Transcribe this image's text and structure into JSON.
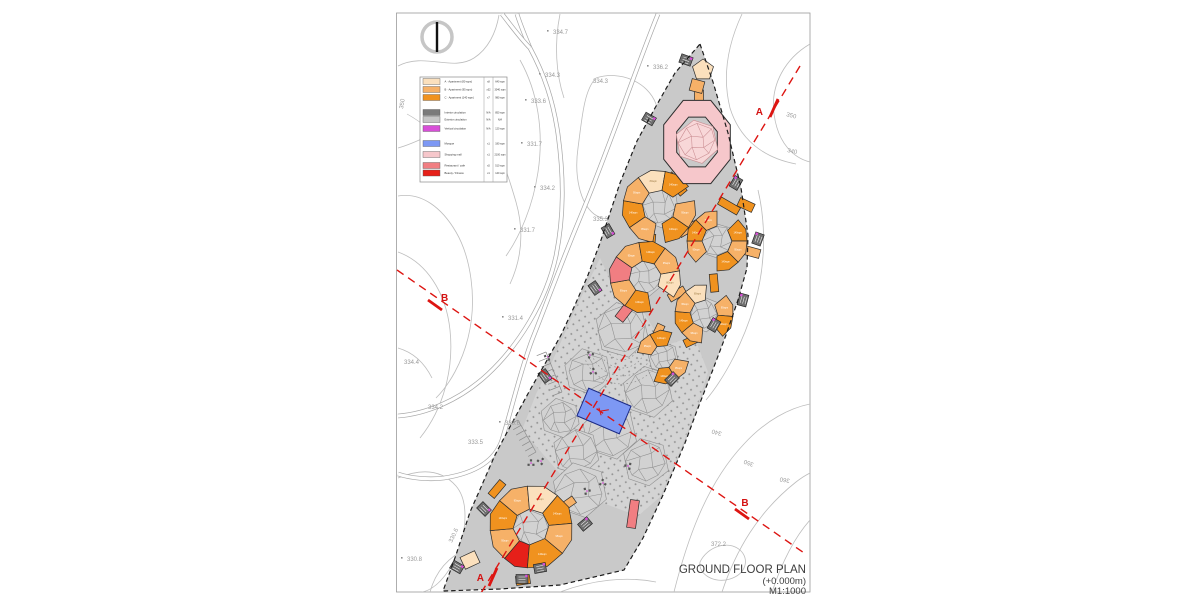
{
  "title": {
    "line1": "GROUND FLOOR PLAN",
    "line2": "(+0.000m)",
    "line3": "M1:1000"
  },
  "colors": {
    "cream": "#fbe0bd",
    "ltorange": "#f6b168",
    "orange": "#f0921f",
    "salmon": "#f17e82",
    "red": "#e62019",
    "pink": "#f6c7cb",
    "pinkLight": "#f8d7d8",
    "pinkLine": "#c98b90",
    "blue": "#7d98f4",
    "blueStroke": "#1b2a86",
    "magenta": "#d84fd8",
    "coreGray": "#6e6e6e",
    "legendGray": "#7a7a7a",
    "legendLtGray": "#c6c6c6",
    "siteGray": "#c9c9c9",
    "plazaGray": "#d4d4d4",
    "dotGray": "#939393",
    "courtGray": "#d2d2d2",
    "courtLine": "#8f8f8f",
    "contour": "#bdbdbd",
    "road": "#a6a6a6",
    "sectionRed": "#dd1512",
    "boundary": "#1c1c1c",
    "label": "#999999",
    "buildingStroke": "#2b2b2b",
    "sheetBorder": "#9a9a9a"
  },
  "legend": {
    "rows": [
      {
        "label": "A · Apartment (80 sqm)",
        "qty": "x8",
        "area": "640 sqm",
        "color": "cream"
      },
      {
        "label": "B · Apartment (95 sqm)",
        "qty": "x32",
        "area": "3040 sqm",
        "color": "ltorange"
      },
      {
        "label": "C · Apartment (140 sqm)",
        "qty": "x7",
        "area": "980 sqm",
        "color": "orange"
      },
      {
        "label": "Interior circulation",
        "qty": "N/A",
        "area": "850 sqm",
        "color": "legendGray"
      },
      {
        "label": "Exterior circulation",
        "qty": "N/A",
        "area": "N/A",
        "color": "legendLtGray"
      },
      {
        "label": "Vertical circulation",
        "qty": "N/A",
        "area": "120 sqm",
        "color": "magenta"
      },
      {
        "label": "Mosque",
        "qty": "x1",
        "area": "180 sqm",
        "color": "blue"
      },
      {
        "label": "Shopping mall",
        "qty": "x1",
        "area": "2100 sqm",
        "color": "pink"
      },
      {
        "label": "Restaurant / cafe",
        "qty": "x5",
        "area": "510 sqm",
        "color": "salmon"
      },
      {
        "label": "Beauty / Fitness",
        "qty": "x1",
        "area": "140 sqm",
        "color": "red"
      }
    ],
    "row_y": [
      81.5,
      89.5,
      97.5,
      112.5,
      119.5,
      128.5,
      143.5,
      154.5,
      165.5,
      173
    ]
  },
  "sections": {
    "a": {
      "label": "A",
      "x1": 800,
      "y1": 66,
      "x2": 478,
      "y2": 598,
      "marks": [
        {
          "lx": 763,
          "ly": 115,
          "anchor": "end",
          "sx1": 770,
          "sy1": 117,
          "sx2": 778,
          "sy2": 99
        },
        {
          "lx": 484,
          "ly": 581,
          "anchor": "end",
          "sx1": 489,
          "sy1": 586,
          "sx2": 497,
          "sy2": 568
        }
      ]
    },
    "b": {
      "label": "B",
      "x1": 397,
      "y1": 270,
      "x2": 807,
      "y2": 555,
      "marks": [
        {
          "lx": 441,
          "ly": 301,
          "anchor": "start",
          "sx1": 428,
          "sy1": 300,
          "sx2": 442,
          "sy2": 310
        },
        {
          "lx": 745,
          "ly": 506,
          "anchor": "middle",
          "sx1": 735,
          "sy1": 509,
          "sx2": 749,
          "sy2": 519
        }
      ]
    }
  },
  "contour_labels": [
    {
      "t": "334.7",
      "x": 553,
      "y": 34,
      "r": 0,
      "d": 1
    },
    {
      "t": "334.3",
      "x": 545,
      "y": 77,
      "r": 0,
      "d": 1
    },
    {
      "t": "334.3",
      "x": 593,
      "y": 83,
      "r": 0,
      "d": 0
    },
    {
      "t": "333.6",
      "x": 531,
      "y": 103,
      "r": 0,
      "d": 1
    },
    {
      "t": "336.2",
      "x": 653,
      "y": 69,
      "r": 0,
      "d": 1
    },
    {
      "t": "331.7",
      "x": 527,
      "y": 146,
      "r": 0,
      "d": 1
    },
    {
      "t": "334.2",
      "x": 540,
      "y": 190,
      "r": 0,
      "d": 1
    },
    {
      "t": "331.7",
      "x": 520,
      "y": 232,
      "r": 0,
      "d": 1
    },
    {
      "t": "335.3",
      "x": 593,
      "y": 221,
      "r": 0,
      "d": 0
    },
    {
      "t": "331.4",
      "x": 508,
      "y": 320,
      "r": 0,
      "d": 1
    },
    {
      "t": "334.4",
      "x": 404,
      "y": 364,
      "r": 0,
      "d": 0
    },
    {
      "t": "334.2",
      "x": 428,
      "y": 409,
      "r": 0,
      "d": 0
    },
    {
      "t": "330.6",
      "x": 505,
      "y": 425,
      "r": 0,
      "d": 1
    },
    {
      "t": "333.5",
      "x": 468,
      "y": 444,
      "r": 0,
      "d": 0
    },
    {
      "t": "330.8",
      "x": 407,
      "y": 561,
      "r": 0,
      "d": 1
    },
    {
      "t": "330.6",
      "x": 452,
      "y": 543,
      "r": -65,
      "d": 0
    },
    {
      "t": "372.2",
      "x": 711,
      "y": 546,
      "r": 0,
      "d": 0
    },
    {
      "t": "350",
      "x": 786,
      "y": 116,
      "r": 15,
      "d": 0
    },
    {
      "t": "340",
      "x": 787,
      "y": 152,
      "r": 12,
      "d": 0
    },
    {
      "t": "340",
      "x": 722,
      "y": 432,
      "r": 195,
      "d": 0
    },
    {
      "t": "350",
      "x": 754,
      "y": 463,
      "r": 200,
      "d": 0
    },
    {
      "t": "360",
      "x": 790,
      "y": 479,
      "r": 190,
      "d": 0
    },
    {
      "t": "350",
      "x": 403,
      "y": 109,
      "r": -80,
      "d": 0
    }
  ],
  "sheet": {
    "x": 396.5,
    "y": 13,
    "w": 413.5,
    "h": 579
  },
  "north": {
    "cx": 437,
    "cy": 37,
    "r": 15
  },
  "contours": [
    "M398,66 C425,52 452,72 474,58 C488,49 496,33 499,15",
    "M398,148 C428,140 452,118 472,126 C496,136 506,168 516,202 C524,230 522,258 510,284",
    "M398,196 C422,192 442,208 456,232 C470,256 478,298 468,338 C462,362 450,384 436,398",
    "M398,252 C426,262 446,292 450,330 C454,368 444,408 420,438",
    "M398,478 C422,468 442,470 456,486 C468,500 468,528 456,556 C448,576 434,590 422,592",
    "M430,592 C436,570 450,556 468,548",
    "M596,78 C620,70 648,82 656,104 C664,128 658,162 644,190 C632,214 610,226 594,214 C580,203 574,176 578,148 C582,118 584,90 596,78",
    "M560,14 C554,44 556,74 564,98",
    "M520,60 C538,92 544,132 538,172 C533,206 520,236 506,256",
    "M742,14 C728,44 722,76 730,108 C740,140 764,158 796,164",
    "M810,44 C786,58 770,84 774,114 C778,144 794,158 810,162",
    "M758,190 C766,224 766,266 754,306 C744,340 726,376 706,400",
    "M672,600 C686,542 706,484 744,444 C766,420 790,408 810,404",
    "M722,592 C736,550 758,512 796,482 C801,478 806,475 810,473",
    "M772,592 C782,562 794,538 810,520",
    "M700,562 C708,546 728,540 740,550 C750,559 746,574 730,579 C714,584 698,574 700,562",
    "M560,592 C592,580 626,576 656,582",
    "M398,348 C412,352 424,362 432,378"
  ],
  "roads": [
    "M658,14 C636,68 610,146 580,218 C560,266 548,300 532,340 C520,372 512,408 502,440 C494,464 470,474 444,478 C428,480 410,478 398,474",
    "M517,14 C520,24 525,36 530,48 C544,74 553,100 558,134 C564,178 564,216 556,256 C546,302 518,346 488,374 C458,402 424,414 398,416",
    "M502,14 C510,24 520,38 530,48"
  ],
  "site": {
    "boundary": [
      [
        700,
        44
      ],
      [
        713,
        82
      ],
      [
        728,
        133
      ],
      [
        741,
        188
      ],
      [
        748,
        235
      ],
      [
        747,
        268
      ],
      [
        738,
        300
      ],
      [
        726,
        335
      ],
      [
        712,
        372
      ],
      [
        698,
        408
      ],
      [
        685,
        443
      ],
      [
        663,
        495
      ],
      [
        643,
        538
      ],
      [
        624,
        570
      ],
      [
        560,
        585
      ],
      [
        500,
        589
      ],
      [
        443,
        591
      ],
      [
        456,
        555
      ],
      [
        470,
        512
      ],
      [
        478,
        494
      ],
      [
        495,
        455
      ],
      [
        512,
        423
      ],
      [
        530,
        390
      ],
      [
        546,
        362
      ],
      [
        561,
        335
      ],
      [
        575,
        305
      ],
      [
        588,
        275
      ],
      [
        600,
        243
      ],
      [
        610,
        213
      ],
      [
        620,
        183
      ],
      [
        637,
        141
      ],
      [
        655,
        108
      ],
      [
        675,
        73
      ]
    ],
    "plaza": [
      [
        600,
        258
      ],
      [
        616,
        292
      ],
      [
        640,
        306
      ],
      [
        664,
        346
      ],
      [
        694,
        336
      ],
      [
        708,
        372
      ],
      [
        696,
        410
      ],
      [
        682,
        446
      ],
      [
        660,
        497
      ],
      [
        638,
        516
      ],
      [
        600,
        502
      ],
      [
        562,
        476
      ],
      [
        522,
        430
      ],
      [
        536,
        394
      ],
      [
        552,
        362
      ],
      [
        576,
        308
      ]
    ],
    "patches": [
      [
        622,
        330,
        26
      ],
      [
        588,
        372,
        22
      ],
      [
        648,
        392,
        24
      ],
      [
        610,
        432,
        26
      ],
      [
        576,
        452,
        22
      ],
      [
        646,
        462,
        22
      ],
      [
        560,
        418,
        18
      ],
      [
        580,
        490,
        26
      ]
    ],
    "amphi": {
      "cx": 622,
      "cy": 344,
      "radii": [
        16,
        24,
        32,
        40
      ],
      "a0": 15,
      "a1": 165
    },
    "stairs": [
      [
        546,
        352,
        562,
        392,
        7,
        10
      ],
      [
        518,
        420,
        536,
        452,
        6,
        9
      ]
    ]
  },
  "ring": {
    "cx": 697,
    "cy": 142,
    "rx": 36,
    "ry": 45,
    "irx": 22,
    "iry": 27
  },
  "clusters": [
    {
      "c": [
        659,
        207
      ],
      "ri": 17,
      "ro": 36,
      "segs": [
        [
          100,
          145,
          "B"
        ],
        [
          145,
          190,
          "C"
        ],
        [
          190,
          235,
          "B"
        ],
        [
          235,
          280,
          "A"
        ],
        [
          280,
          325,
          "C"
        ],
        [
          -10,
          35,
          "B"
        ],
        [
          35,
          80,
          "C"
        ]
      ]
    },
    {
      "c": [
        717,
        241
      ],
      "ri": 15,
      "ro": 30,
      "segs": [
        [
          -45,
          0,
          "C"
        ],
        [
          0,
          45,
          "B"
        ],
        [
          45,
          90,
          "C"
        ],
        [
          135,
          180,
          "B"
        ],
        [
          180,
          225,
          "C"
        ],
        [
          225,
          270,
          "B"
        ]
      ]
    },
    {
      "c": [
        645,
        277
      ],
      "ri": 16,
      "ro": 35,
      "segs": [
        [
          80,
          125,
          "C"
        ],
        [
          125,
          170,
          "B"
        ],
        [
          170,
          215,
          "S"
        ],
        [
          215,
          260,
          "B"
        ],
        [
          260,
          305,
          "C"
        ],
        [
          305,
          350,
          "B"
        ],
        [
          -10,
          35,
          "A"
        ]
      ]
    },
    {
      "c": [
        704,
        314
      ],
      "ri": 14,
      "ro": 29,
      "segs": [
        [
          -40,
          5,
          "B"
        ],
        [
          5,
          50,
          "C"
        ],
        [
          95,
          140,
          "B"
        ],
        [
          140,
          185,
          "C"
        ],
        [
          185,
          230,
          "B"
        ],
        [
          230,
          275,
          "A"
        ]
      ]
    },
    {
      "c": [
        663,
        357
      ],
      "ri": 12,
      "ro": 26,
      "segs": [
        [
          10,
          60,
          "B"
        ],
        [
          60,
          110,
          "C"
        ],
        [
          190,
          240,
          "B"
        ],
        [
          240,
          290,
          "C"
        ]
      ]
    },
    {
      "c": [
        531,
        527
      ],
      "ri": 18,
      "ro": 41,
      "segs": [
        [
          95,
          130,
          "R"
        ],
        [
          130,
          175,
          "B"
        ],
        [
          175,
          220,
          "C"
        ],
        [
          220,
          265,
          "B"
        ],
        [
          265,
          310,
          "A"
        ],
        [
          310,
          355,
          "C"
        ],
        [
          -5,
          40,
          "B"
        ],
        [
          40,
          95,
          "C"
        ]
      ]
    }
  ],
  "corridors": [
    [
      699,
      103,
      9,
      26,
      0,
      "B"
    ],
    [
      676,
      184,
      9,
      24,
      -40,
      "C"
    ],
    [
      729,
      206,
      8,
      22,
      -60,
      "C"
    ],
    [
      688,
      229,
      8,
      20,
      60,
      "B"
    ],
    [
      651,
      243,
      8,
      18,
      5,
      "C"
    ],
    [
      677,
      294,
      8,
      18,
      60,
      "B"
    ],
    [
      714,
      283,
      8,
      18,
      -5,
      "C"
    ],
    [
      627,
      309,
      10,
      26,
      38,
      "S"
    ],
    [
      658,
      332,
      8,
      16,
      25,
      "B"
    ],
    [
      691,
      341,
      8,
      14,
      65,
      "C"
    ],
    [
      633,
      514,
      9,
      28,
      8,
      "S"
    ],
    [
      566,
      505,
      8,
      20,
      55,
      "B"
    ],
    [
      497,
      489,
      8,
      18,
      40,
      "C"
    ],
    [
      746,
      205,
      9,
      16,
      -65,
      "C"
    ],
    [
      752,
      252,
      9,
      16,
      -75,
      "B"
    ],
    [
      470,
      560,
      16,
      13,
      -25,
      "A"
    ],
    [
      523,
      580,
      14,
      9,
      -8,
      "C"
    ]
  ],
  "apex": {
    "pent": [
      703,
      70,
      11
    ],
    "bar": [
      697,
      86,
      13,
      12,
      15
    ]
  },
  "cores": [
    [
      686,
      60,
      20
    ],
    [
      649,
      119,
      30
    ],
    [
      736,
      183,
      -60
    ],
    [
      758,
      239,
      -70
    ],
    [
      743,
      300,
      -75
    ],
    [
      714,
      325,
      -60
    ],
    [
      672,
      379,
      -45
    ],
    [
      608,
      231,
      60
    ],
    [
      595,
      288,
      55
    ],
    [
      545,
      376,
      55
    ],
    [
      484,
      509,
      45
    ],
    [
      457,
      567,
      30
    ],
    [
      522,
      579,
      0
    ],
    [
      585,
      524,
      -40
    ],
    [
      540,
      568,
      -10
    ]
  ],
  "trees": [
    [
      531,
      463
    ],
    [
      541,
      461
    ],
    [
      587,
      491
    ],
    [
      603,
      483
    ],
    [
      548,
      357
    ],
    [
      590,
      355
    ],
    [
      593,
      372
    ],
    [
      628,
      466
    ]
  ],
  "mosque": {
    "cx": 604,
    "cy": 411,
    "w": 46,
    "h": 30,
    "rot": 23
  },
  "seg_labels": {
    "A": "80sqm",
    "B": "95sqm",
    "C": "140sqm"
  },
  "legend_box": {
    "x": 420,
    "y": 77,
    "w": 87,
    "h": 105,
    "div1": 484,
    "div2": 493
  }
}
